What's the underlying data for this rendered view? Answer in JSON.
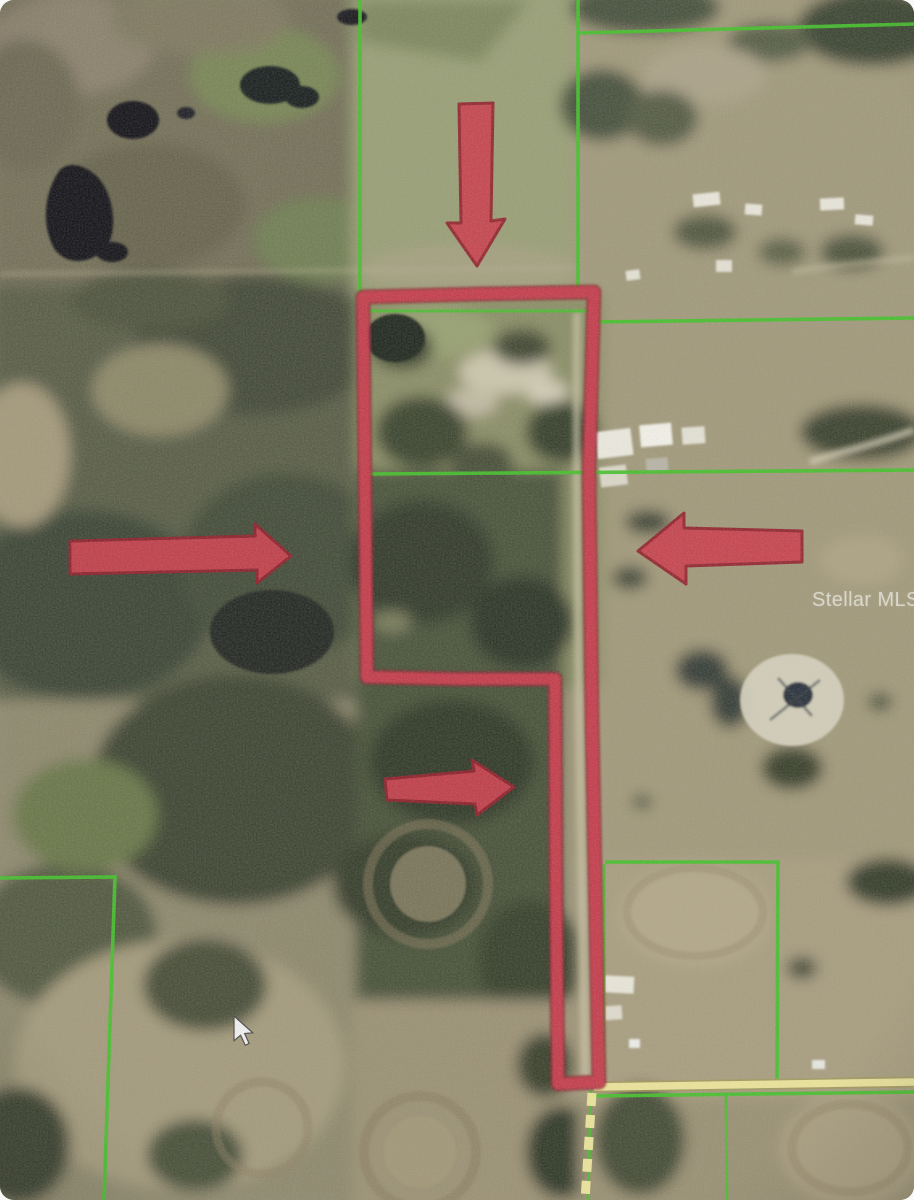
{
  "map": {
    "watermark": "Stellar MLS"
  },
  "annotations": {
    "arrows": [
      {
        "name": "top-arrow",
        "direction": "down",
        "points_at": "north boundary of outlined property"
      },
      {
        "name": "west-arrow",
        "direction": "right",
        "points_at": "west side of outlined property"
      },
      {
        "name": "east-arrow",
        "direction": "left",
        "points_at": "east boundary of outlined property"
      },
      {
        "name": "middle-arrow",
        "direction": "right",
        "points_at": "south lobe of outlined property"
      }
    ],
    "property_boundary": {
      "style": "hand-drawn thick outline",
      "color": "#c8404e"
    },
    "parcel_lines": {
      "color": "#44c22c"
    },
    "road": {
      "color": "#ebe49c",
      "style": "solid horizontal road with dashed vertical branch at bottom right"
    }
  },
  "cursor": {
    "style": "pointer-arrow",
    "color": "#f0f0f0"
  },
  "colors": {
    "terrain-base": "#9c957a",
    "arrow-fill": "#c9414f",
    "arrow-edge": "#93232f",
    "boundary-main": "#c8404e",
    "boundary-under": "#8e2533",
    "parcel-green": "#44c22c",
    "road-yellow": "#ebe49c",
    "road-edge": "#a29a5e"
  }
}
